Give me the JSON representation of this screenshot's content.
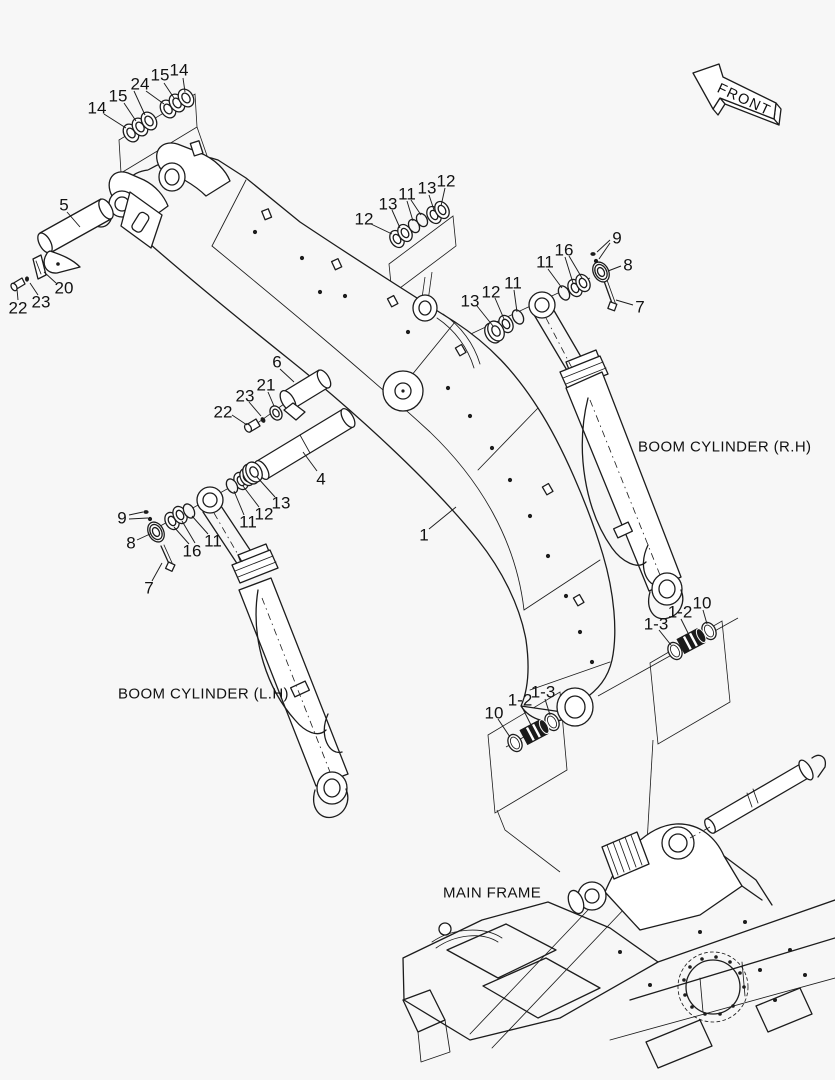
{
  "diagram": {
    "colors": {
      "background": "#f7f7f7",
      "line": "#1c1c1c",
      "dark_part": "#1a1a1a"
    },
    "front_marker": {
      "label": "FRONT"
    },
    "annotations": [
      {
        "id": "boom-cylinder-rh",
        "text": "BOOM CYLINDER (R.H)",
        "x": 638,
        "y": 447
      },
      {
        "id": "boom-cylinder-lh",
        "text": "BOOM CYLINDER (L.H)",
        "x": 118,
        "y": 694
      },
      {
        "id": "main-frame",
        "text": "MAIN FRAME",
        "x": 443,
        "y": 893
      }
    ],
    "part_labels": [
      {
        "text": "14",
        "x": 97,
        "y": 108,
        "leaders": [
          [
            104,
            114,
            126,
            128
          ]
        ]
      },
      {
        "text": "15",
        "x": 118,
        "y": 96,
        "leaders": [
          [
            124,
            103,
            136,
            121
          ]
        ]
      },
      {
        "text": "24",
        "x": 140,
        "y": 84,
        "leaders": [
          [
            134,
            91,
            145,
            115
          ],
          [
            146,
            91,
            164,
            104
          ]
        ]
      },
      {
        "text": "15",
        "x": 160,
        "y": 75,
        "leaders": [
          [
            164,
            83,
            174,
            98
          ]
        ]
      },
      {
        "text": "14",
        "x": 179,
        "y": 70,
        "leaders": [
          [
            183,
            78,
            185,
            92
          ]
        ]
      },
      {
        "text": "12",
        "x": 364,
        "y": 219,
        "leaders": [
          [
            371,
            224,
            392,
            234
          ]
        ]
      },
      {
        "text": "13",
        "x": 388,
        "y": 204,
        "leaders": [
          [
            392,
            210,
            400,
            228
          ]
        ]
      },
      {
        "text": "11",
        "x": 407,
        "y": 194,
        "leaders": [
          [
            407,
            201,
            413,
            221
          ],
          [
            411,
            200,
            421,
            215
          ]
        ]
      },
      {
        "text": "13",
        "x": 427,
        "y": 188,
        "leaders": [
          [
            429,
            195,
            434,
            210
          ]
        ]
      },
      {
        "text": "12",
        "x": 446,
        "y": 181,
        "leaders": [
          [
            445,
            188,
            441,
            206
          ]
        ]
      },
      {
        "text": "13",
        "x": 470,
        "y": 301,
        "leaders": [
          [
            477,
            306,
            493,
            326
          ]
        ]
      },
      {
        "text": "12",
        "x": 491,
        "y": 292,
        "leaders": [
          [
            495,
            298,
            504,
            319
          ]
        ]
      },
      {
        "text": "11",
        "x": 513,
        "y": 283,
        "leaders": [
          [
            514,
            290,
            517,
            312
          ]
        ]
      },
      {
        "text": "11",
        "x": 545,
        "y": 262,
        "leaders": [
          [
            548,
            269,
            562,
            288
          ]
        ]
      },
      {
        "text": "16",
        "x": 564,
        "y": 250,
        "leaders": [
          [
            565,
            257,
            573,
            283
          ],
          [
            569,
            256,
            582,
            278
          ]
        ]
      },
      {
        "text": "9",
        "x": 617,
        "y": 238,
        "leaders": [
          [
            610,
            240,
            597,
            252
          ],
          [
            610,
            243,
            599,
            259
          ]
        ]
      },
      {
        "text": "8",
        "x": 628,
        "y": 265,
        "leaders": [
          [
            621,
            266,
            608,
            271
          ]
        ]
      },
      {
        "text": "7",
        "x": 640,
        "y": 307,
        "leaders": [
          [
            633,
            305,
            616,
            300
          ]
        ]
      },
      {
        "text": "5",
        "x": 64,
        "y": 205,
        "leaders": [
          [
            67,
            212,
            80,
            227
          ]
        ]
      },
      {
        "text": "20",
        "x": 64,
        "y": 288,
        "leaders": [
          [
            56,
            283,
            44,
            272
          ]
        ]
      },
      {
        "text": "23",
        "x": 41,
        "y": 302,
        "leaders": [
          [
            38,
            295,
            30,
            283
          ]
        ]
      },
      {
        "text": "22",
        "x": 18,
        "y": 308,
        "leaders": [
          [
            18,
            300,
            17,
            289
          ]
        ]
      },
      {
        "text": "6",
        "x": 277,
        "y": 362,
        "leaders": [
          [
            280,
            369,
            294,
            382
          ]
        ]
      },
      {
        "text": "21",
        "x": 266,
        "y": 385,
        "leaders": [
          [
            268,
            392,
            274,
            406
          ]
        ]
      },
      {
        "text": "23",
        "x": 245,
        "y": 396,
        "leaders": [
          [
            249,
            402,
            261,
            416
          ]
        ]
      },
      {
        "text": "22",
        "x": 223,
        "y": 412,
        "leaders": [
          [
            232,
            415,
            247,
            425
          ]
        ]
      },
      {
        "text": "4",
        "x": 321,
        "y": 479,
        "leaders": [
          [
            317,
            471,
            303,
            452
          ]
        ]
      },
      {
        "text": "9",
        "x": 122,
        "y": 518,
        "leaders": [
          [
            129,
            515,
            143,
            512
          ],
          [
            129,
            519,
            148,
            518
          ]
        ]
      },
      {
        "text": "8",
        "x": 131,
        "y": 543,
        "leaders": [
          [
            137,
            540,
            150,
            534
          ]
        ]
      },
      {
        "text": "16",
        "x": 192,
        "y": 551,
        "leaders": [
          [
            189,
            544,
            174,
            527
          ],
          [
            195,
            543,
            182,
            521
          ]
        ]
      },
      {
        "text": "11",
        "x": 213,
        "y": 541,
        "leaders": [
          [
            208,
            534,
            192,
            516
          ]
        ]
      },
      {
        "text": "11",
        "x": 248,
        "y": 522,
        "leaders": [
          [
            244,
            515,
            234,
            491
          ]
        ]
      },
      {
        "text": "12",
        "x": 264,
        "y": 514,
        "leaders": [
          [
            259,
            507,
            243,
            486
          ]
        ]
      },
      {
        "text": "13",
        "x": 281,
        "y": 503,
        "leaders": [
          [
            275,
            497,
            257,
            477
          ]
        ]
      },
      {
        "text": "7",
        "x": 149,
        "y": 588,
        "leaders": [
          [
            152,
            581,
            162,
            563
          ]
        ]
      },
      {
        "text": "1",
        "x": 424,
        "y": 535,
        "leaders": [
          [
            429,
            529,
            456,
            507
          ]
        ]
      },
      {
        "text": "1-3",
        "x": 656,
        "y": 624,
        "leaders": [
          [
            659,
            630,
            671,
            645
          ]
        ]
      },
      {
        "text": "1-2",
        "x": 680,
        "y": 612,
        "leaders": [
          [
            681,
            619,
            688,
            633
          ]
        ]
      },
      {
        "text": "10",
        "x": 702,
        "y": 603,
        "leaders": [
          [
            703,
            610,
            707,
            624
          ]
        ]
      },
      {
        "text": "10",
        "x": 494,
        "y": 713,
        "leaders": [
          [
            498,
            719,
            510,
            737
          ]
        ]
      },
      {
        "text": "1-2",
        "x": 520,
        "y": 700,
        "leaders": [
          [
            522,
            707,
            531,
            725
          ]
        ]
      },
      {
        "text": "1-3",
        "x": 543,
        "y": 692,
        "leaders": [
          [
            545,
            699,
            550,
            715
          ]
        ]
      }
    ]
  }
}
